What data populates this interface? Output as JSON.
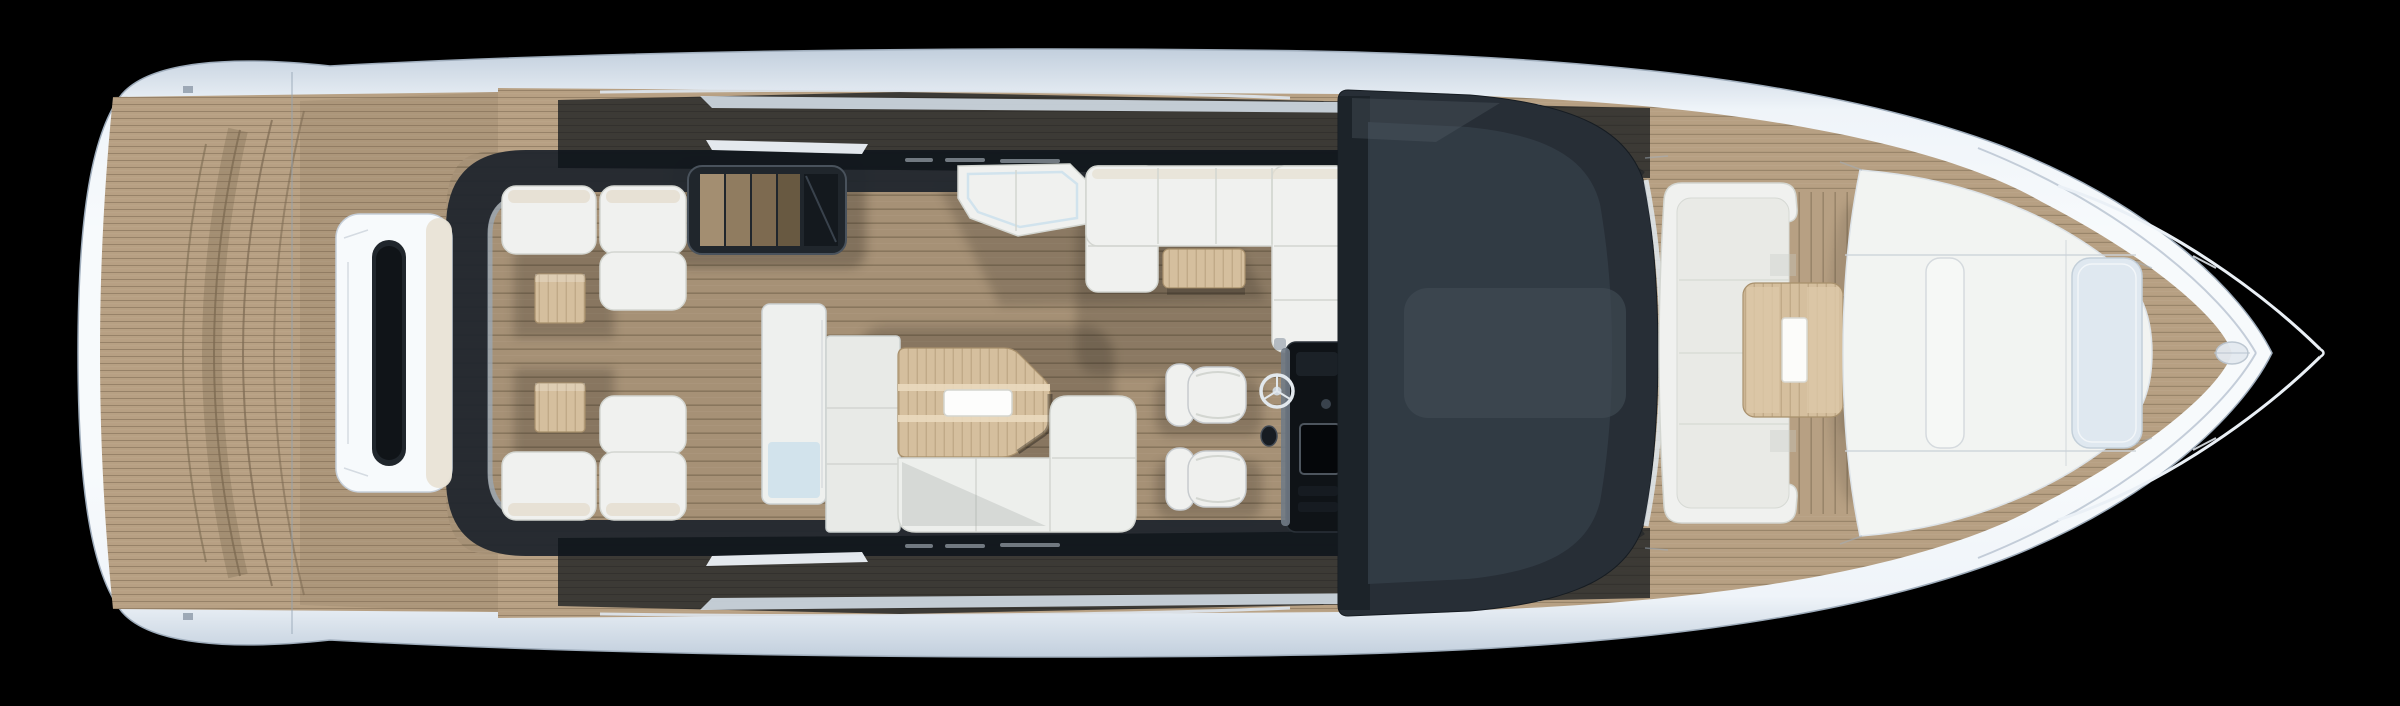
{
  "scene": {
    "type": "yacht-main-deck-plan-top-view-render",
    "orientation": "bow-right-stern-left",
    "background": "#000000"
  },
  "colors": {
    "background": "#000000",
    "hull_edge": "#c2cfdd",
    "hull_light": "#eff4f9",
    "hull_bright": "#f7fafc",
    "hull_line": "#9fadbc",
    "sheer_line": "#b6c2cf",
    "chrome": "#dfe7f0",
    "chrome_dark": "#9aa6b3",
    "teak": "#b7a083",
    "teak_seam": "#7c6a52",
    "teak_shade": "#6f6049",
    "wood_light": "#d5bf9e",
    "wood_pale": "#dcc8a8",
    "wood_dark": "#a8906c",
    "glass_dark": "#272e36",
    "glass_panel": "#353f49",
    "glass_light": "#414b55",
    "glass_deep": "#1b2127",
    "frame_dark": "#20262d",
    "gloss_dark": "#0d1218",
    "white_furniture": "#f0f1ef",
    "cushion": "#e9eae6",
    "cushion_line": "#d3d6d1",
    "beige_pad": "#e6dfd1",
    "ivory_trim": "#e9e3d6",
    "sink": "#fdfdfc",
    "pale_glass": "#cfe2ec",
    "pale_hatch": "#dfe8f0",
    "console_dark": "#0f1317",
    "console_metal": "#717b86",
    "stair_a": "#a38e71",
    "stair_b": "#907c60",
    "stair_c": "#7d6a50",
    "stair_d": "#685941"
  },
  "zones": {
    "swim_platform": {
      "label": "Teak swim platform (stern)"
    },
    "transom_console": {
      "label": "Transom console with dark hatch slot"
    },
    "cockpit_frame": {
      "label": "Dark cockpit coaming frame"
    },
    "aft_lounge_port": {
      "label": "Aft deck L-sofa with side table (port)"
    },
    "aft_lounge_starboard": {
      "label": "Aft deck L-sofa with side table (starboard)"
    },
    "stairwell": {
      "label": "Companionway stairs to lower deck"
    },
    "sun_lounger": {
      "label": "Cockpit sun lounger chaise"
    },
    "galley_door": {
      "label": "Galley sliding door unit"
    },
    "galley_cabinet": {
      "label": "Galley cabinet module"
    },
    "wet_bar": {
      "label": "Cockpit wet bar with sink"
    },
    "modular_sofa": {
      "label": "L-shaped modular sofa"
    },
    "dinette": {
      "label": "U-shaped dinette sofa"
    },
    "dinette_table": {
      "label": "Dinette table"
    },
    "helm": {
      "label": "Helm console with steering wheel"
    },
    "helm_seats": {
      "label": "Twin helm bucket seats"
    },
    "coachroof": {
      "label": "Dark glass coachroof skylight"
    },
    "bow_lounge": {
      "label": "Bow C-shaped sofa"
    },
    "bow_table": {
      "label": "Bow cocktail table with tray"
    },
    "sunpad": {
      "label": "Bow sunpad with backrest divider"
    },
    "bow_hatch": {
      "label": "Bow hatch / windlass cover"
    },
    "pulpit": {
      "label": "Bow pulpit rails"
    },
    "anchor_cleat": {
      "label": "Bow anchor cleat"
    }
  }
}
